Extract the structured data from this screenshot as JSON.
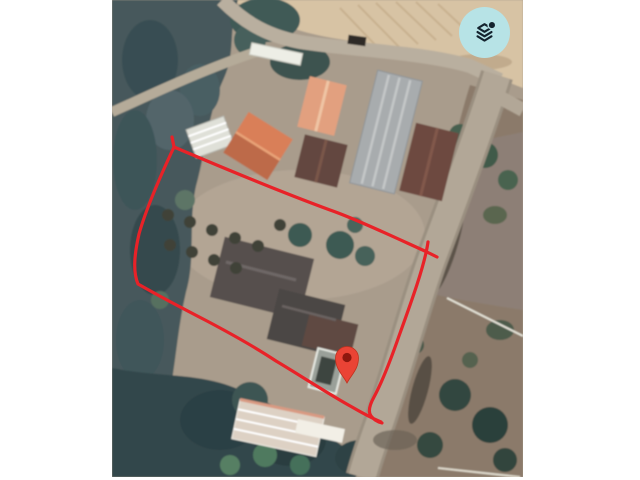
{
  "page": {
    "background_color": "#ffffff"
  },
  "map": {
    "description": "satellite-aerial-imagery-of-rural-property",
    "interaction": "pannable-map-canvas"
  },
  "controls": {
    "layers_button": {
      "icon": "layers-icon",
      "background_color": "#b7e3e6",
      "icon_color": "#14232e",
      "badge_dot": true
    }
  },
  "overlay": {
    "boundary": {
      "label": "property-boundary",
      "color": "#e82228",
      "stroke_width": "3.2",
      "path": "M172 137 L174 147 C159 179 146 209 139 234 C134 256 133 272 138 284 C152 292 176 305 207 321 C241 339 264 353 276 361 C298 374 330 395 352 407 C364 414 374 419 381 422 M174 147 C228 170 281 192 330 210 C356 219 396 238 427 252 L437 257 M428 242 C425 264 412 300 399 336 C391 359 381 384 374 397 C369 406 368 412 371 416 C374 420 378 422 382 423"
    },
    "marker": {
      "label": "location-pin",
      "color": "#ea4335",
      "hole_color": "#8e170e",
      "x": 347,
      "y": 361,
      "transform": "translate(347,361)"
    }
  }
}
